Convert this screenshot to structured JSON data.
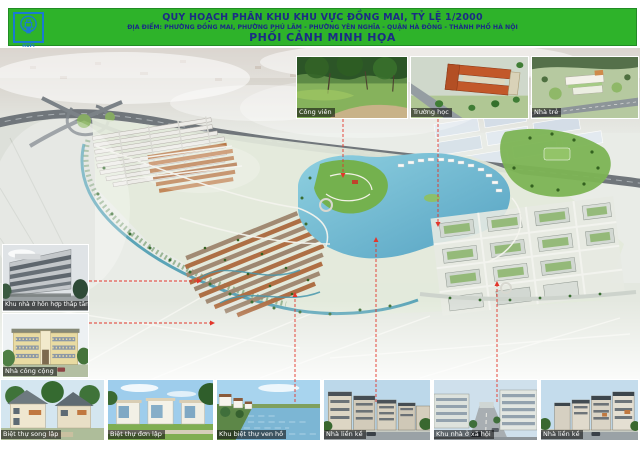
{
  "header": {
    "line1": "QUY HOẠCH PHÂN KHU KHU VỰC ĐỒNG MAI, TỶ LỆ 1/2000",
    "line2": "ĐỊA ĐIỂM: PHƯỜNG ĐỒNG MAI, PHƯỜNG PHÚ LÃM - PHƯỜNG YÊN NGHĨA - QUẬN HÀ ĐÔNG - THÀNH PHỐ HÀ NỘI",
    "line3": "PHỐI CẢNH MINH HỌA",
    "logo_text": "HUPI",
    "bg_color": "#2eb32a",
    "text_color": "#1b2c85",
    "logo_color": "#1a7ad2"
  },
  "insets": {
    "top": [
      {
        "label": "Công viên"
      },
      {
        "label": "Trường học"
      },
      {
        "label": "Nhà trẻ"
      }
    ],
    "left": [
      {
        "label": "Khu nhà ở hỗn hợp thấp tầng"
      },
      {
        "label": "Nhà công cộng"
      }
    ],
    "bottom": [
      {
        "label": "Biệt thự song lập"
      },
      {
        "label": "Biệt thự đơn lập"
      },
      {
        "label": "Khu biệt thự ven hồ"
      },
      {
        "label": "Nhà liền kề"
      },
      {
        "label": "Khu nhà ở xã hội"
      },
      {
        "label": "Nhà liền kề"
      }
    ]
  },
  "plan": {
    "leader_color": "#e2362b",
    "lake_color": "#5fa8c6",
    "label_bg": "rgba(12,12,12,0.58)"
  }
}
